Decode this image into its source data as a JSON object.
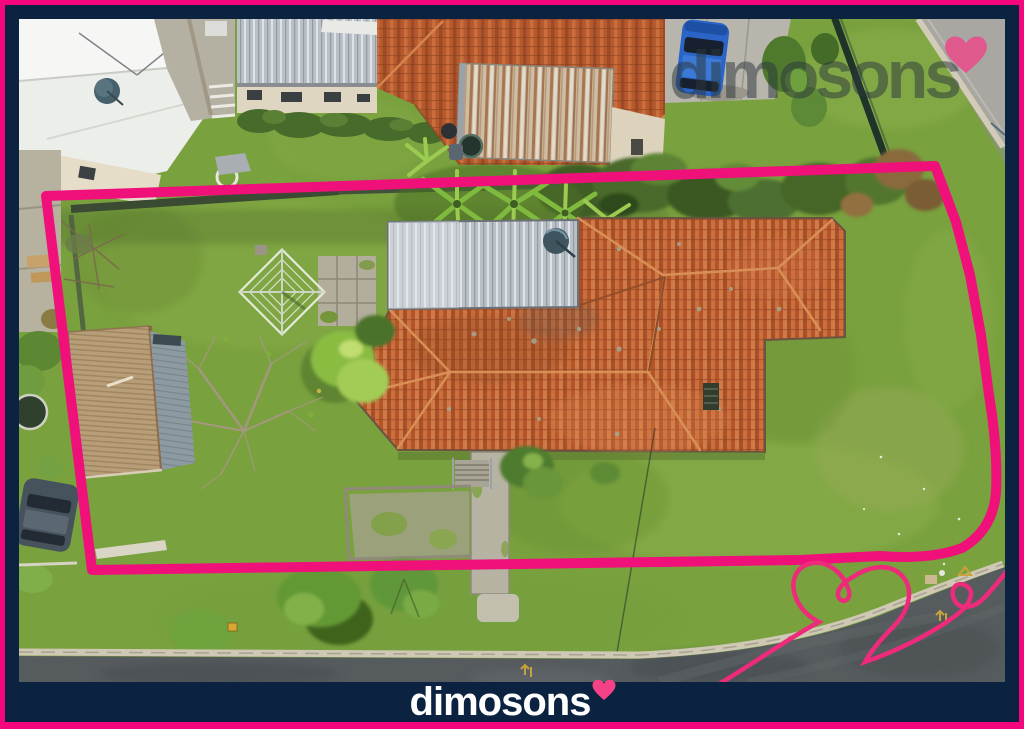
{
  "brand": {
    "watermark_text": "dimosons",
    "logo_text": "dimosons"
  },
  "icons": {
    "watermark_heart": "heart",
    "logo_heart": "heart",
    "boundary_doodle": "hand-drawn heart flourish"
  },
  "colors": {
    "accent_pink": "#f5067e",
    "boundary_pink": "#f0107a",
    "frame_navy": "#0b2341",
    "heart_pink": "#f54287"
  },
  "scene": {
    "type": "aerial drone photograph of residential corner property",
    "overlay": "pink property boundary outline and heart flourish"
  }
}
